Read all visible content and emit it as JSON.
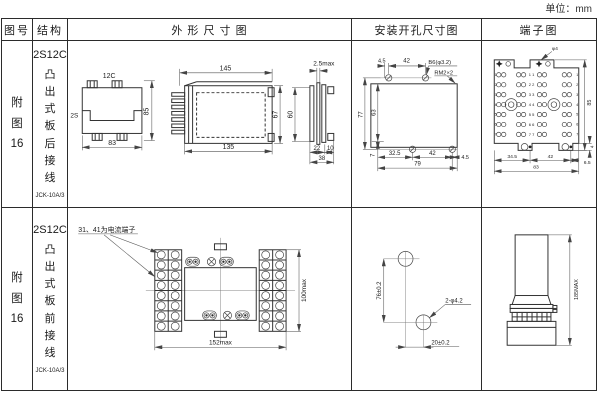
{
  "page": {
    "unit_label": "单位：mm"
  },
  "headers": {
    "fig_no": "图号",
    "structure": "结构",
    "outline": "外 形 尺 寸 图",
    "install": "安装开孔尺寸图",
    "terminal": "端子图"
  },
  "row1": {
    "fig_no": "附图16",
    "model": "2S12C",
    "wiring": "凸出式板后接线",
    "type_code": "JCK-10A/3",
    "outline": {
      "top_label": "12C",
      "left_label": "2S",
      "tv_height": "85",
      "tv_width": "83",
      "sv_top": "145",
      "sv_bottom": "135",
      "sv_h_inner": "67",
      "sv_h_outer": "60",
      "rv_thick": "2.5max",
      "rv_seg1": "22",
      "rv_seg2": "10",
      "rv_total": "38"
    },
    "install": {
      "d_top_offset": "4.5",
      "d_top_span": "42",
      "hole_label": "B6(φ3.2)",
      "thread_label": "RM2×2",
      "d_h_outer": "77",
      "d_h_inner": "63",
      "d_b_offset": "7",
      "d_b_seg1": "32.5",
      "d_b_seg2": "42",
      "d_b_right": "4.5",
      "d_b_total": "79"
    },
    "terminal": {
      "hole_label": "φ4",
      "d_height": "85",
      "d_foot": "4",
      "d_b_seg1": "34.5",
      "d_b_seg2": "42",
      "d_b_right": "6.5",
      "d_b_total": "83",
      "rows_left": [
        "1",
        "2",
        "3",
        "4",
        "5",
        "6",
        "7"
      ],
      "rows_right": [
        "1",
        "2",
        "3",
        "4",
        "5",
        "6",
        "7"
      ],
      "center": [
        "1 1",
        "2 2",
        "3 3",
        "4 4",
        "5 5",
        "6 6",
        "7 7"
      ]
    }
  },
  "row2": {
    "fig_no": "附图16",
    "model": "2S12C",
    "wiring": "凸出式板前接线",
    "type_code": "JCK-10A/3",
    "outline": {
      "note": "31、41为电流端子",
      "d_width": "152max",
      "d_height": "100max"
    },
    "install": {
      "d_vertical": "76±0.2",
      "d_horizontal": "20±0.2",
      "hole_label": "2-φ4.2"
    },
    "terminal": {
      "d_height": "185MAX"
    }
  }
}
